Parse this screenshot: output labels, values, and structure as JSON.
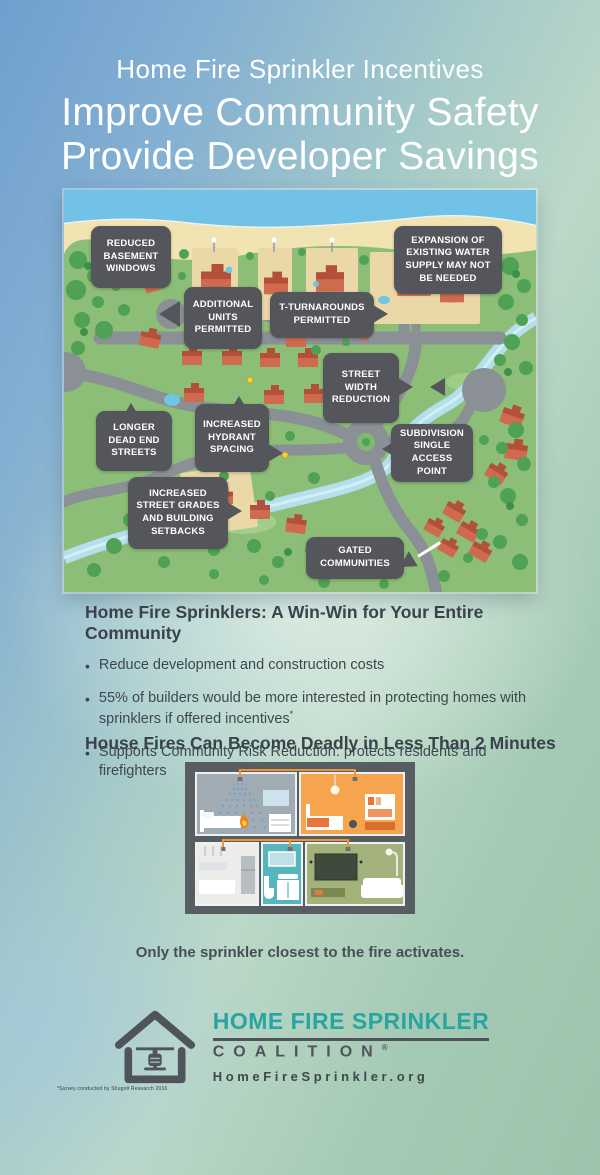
{
  "poster": {
    "title_line1": "Home Fire Sprinkler Incentives",
    "title_line2": "Improve Community Safety",
    "title_line3": "Provide Developer Savings"
  },
  "map_callouts": {
    "reduced_basement": "REDUCED BASEMENT WINDOWS",
    "additional_units": "ADDITIONAL UNITS PERMITTED",
    "t_turnarounds": "T-TURNAROUNDS PERMITTED",
    "expansion_water": "EXPANSION OF EXISTING WATER SUPPLY MAY NOT BE NEEDED",
    "street_width": "STREET WIDTH REDUCTION",
    "longer_dead_end": "LONGER DEAD END STREETS",
    "increased_hydrant": "INCREASED HYDRANT SPACING",
    "subdivision_single": "SUBDIVISION SINGLE ACCESS POINT",
    "increased_grades": "INCREASED STREET GRADES AND BUILDING SETBACKS",
    "gated": "GATED COMMUNITIES"
  },
  "benefits": {
    "heading": "Home Fire Sprinklers: A Win-Win for Your Entire Community",
    "bullet_glyph": "•",
    "bullet1": "Reduce development and construction costs",
    "bullet2": "55% of builders would be more interested in protecting homes with sprinklers if offered incentives",
    "bullet2_marker": "*",
    "bullet3": "Supports Community Risk Reduction: protects residents and firefighters"
  },
  "fire_section": {
    "heading": "House Fires Can Become Deadly in Less Than 2 Minutes",
    "caption": "Only the sprinkler closest to the fire activates."
  },
  "logo": {
    "name": "HOME FIRE SPRINKLER",
    "subname": "COALITION",
    "registered": "®",
    "url": "HomeFireSprinkler.org"
  },
  "footnote": "*Survey conducted by Shugoll Research 2016",
  "colors": {
    "accent_teal": "#27a5a2",
    "callout_gray": "#55565b",
    "heading_gray": "#3a424b",
    "map_land_green": "#8cbe77",
    "pipe_orange": "#ef9433"
  }
}
